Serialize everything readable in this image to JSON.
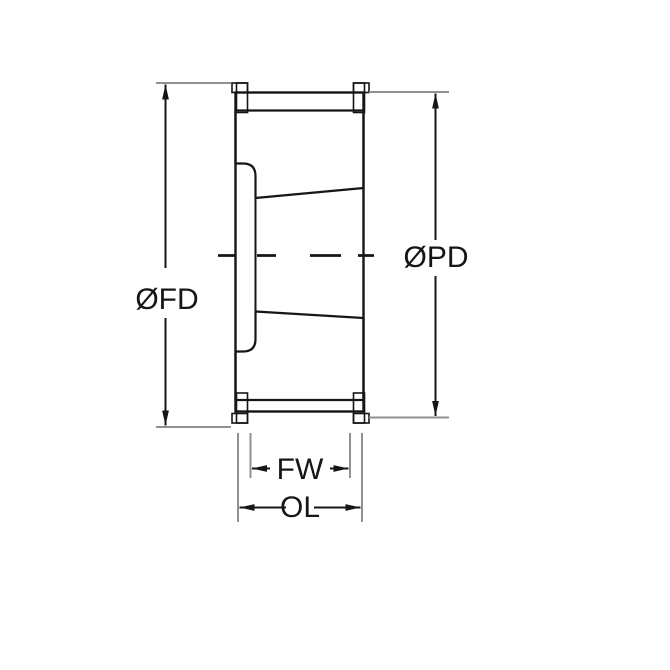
{
  "drawing": {
    "labels": {
      "flange_diameter": "ØFD",
      "pitch_diameter": "ØPD",
      "face_width": "FW",
      "overall_length": "OL"
    },
    "colors": {
      "line": "#161616",
      "extension_line": "#919191",
      "flange_fill": "#111111",
      "background": "#ffffff"
    }
  }
}
